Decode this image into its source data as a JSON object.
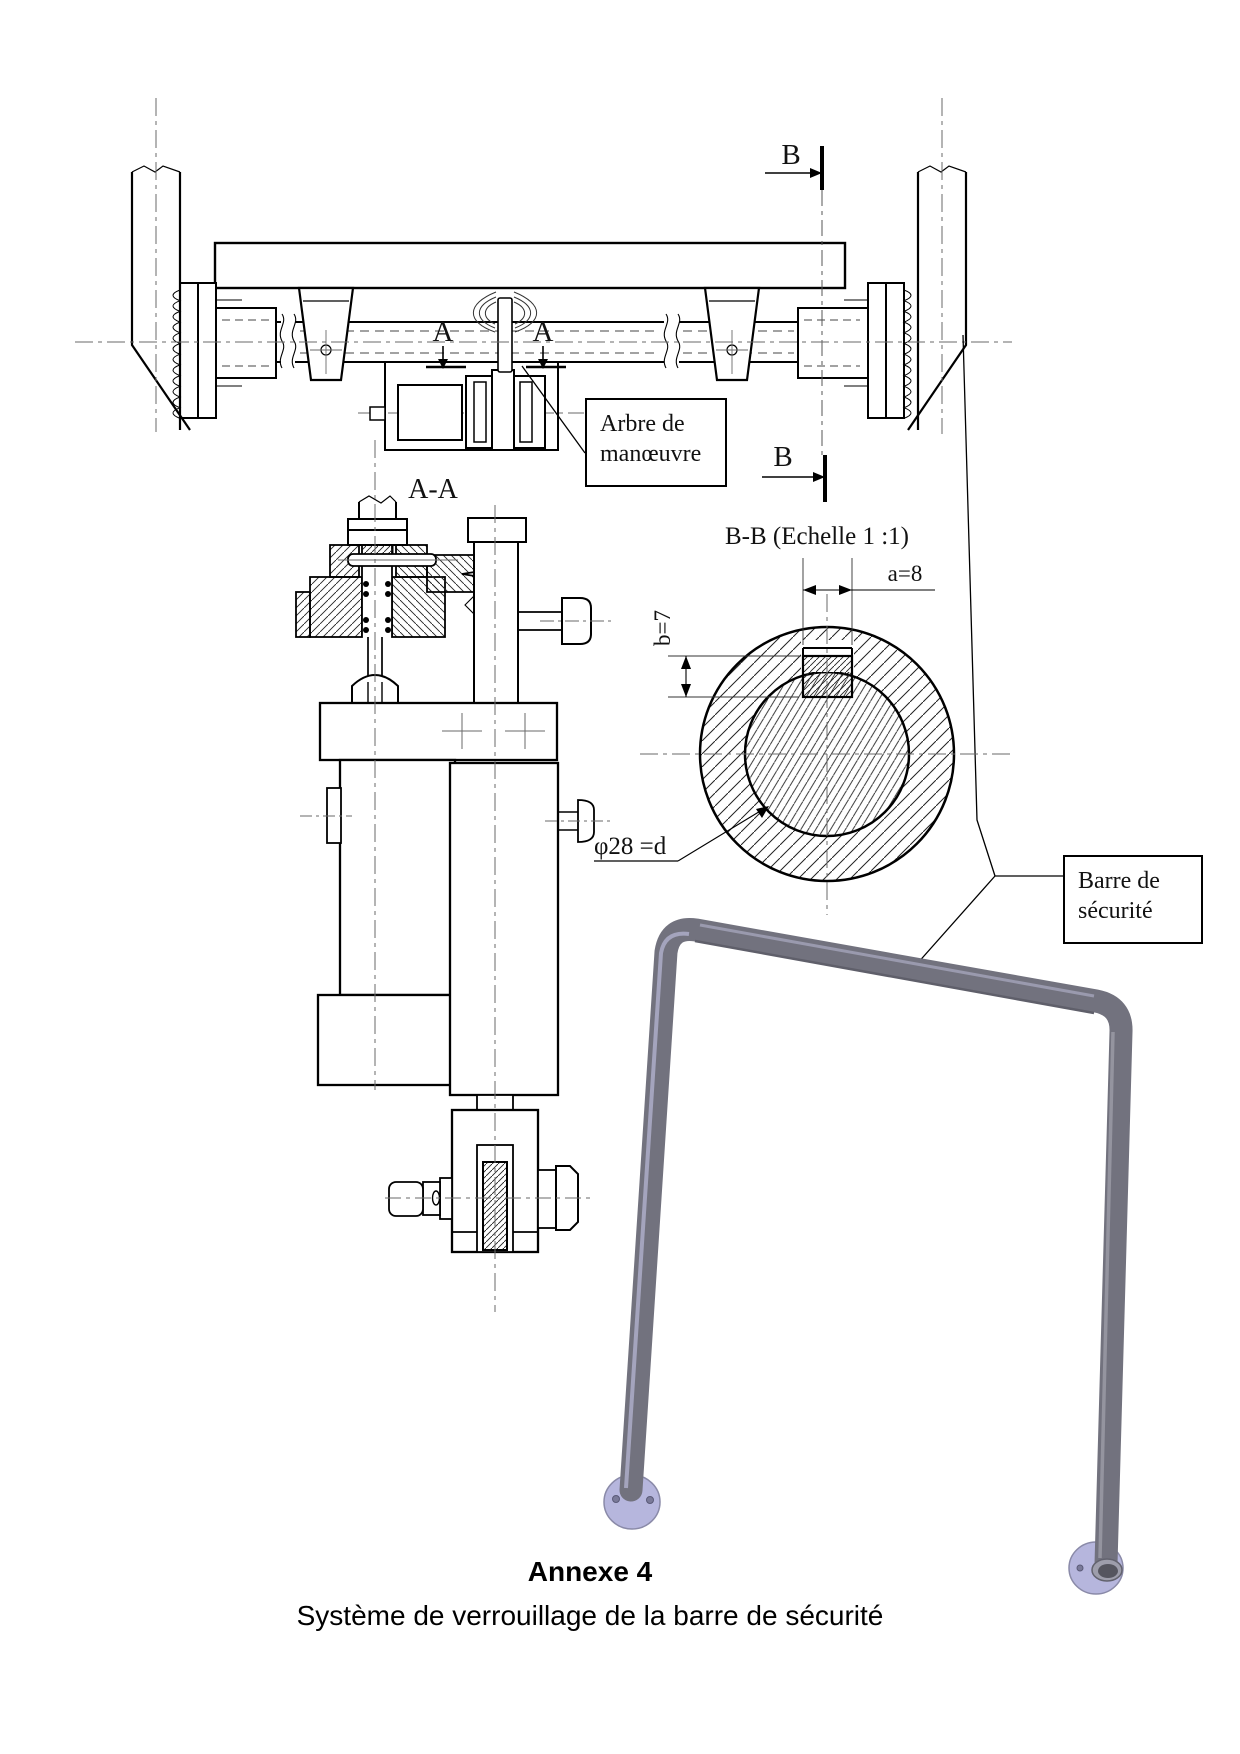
{
  "front_view": {
    "section_a_label": "A",
    "section_b_label": "B",
    "callout_arbre": {
      "line1": "Arbre de",
      "line2": "manœuvre"
    }
  },
  "section_aa": {
    "title": "A-A"
  },
  "section_bb": {
    "title": "B-B (Echelle 1 :1)",
    "dim_width": "a=8",
    "dim_height": "b=7",
    "dim_diameter": "φ28 =d"
  },
  "callout_barre": {
    "line1": "Barre de",
    "line2": "sécurité"
  },
  "caption": {
    "title": "Annexe 4",
    "subtitle": "Système de verrouillage de la barre de sécurité"
  },
  "colors": {
    "line": "#000000",
    "centerline": "#6a6a6a",
    "hatch": "#222222",
    "tube": "#72727e",
    "tube_highlight": "#a4a4bd",
    "tube_shadow": "#5f5f6a",
    "disc": "#b6b6dd",
    "disc_edge": "#8a8aa8"
  }
}
